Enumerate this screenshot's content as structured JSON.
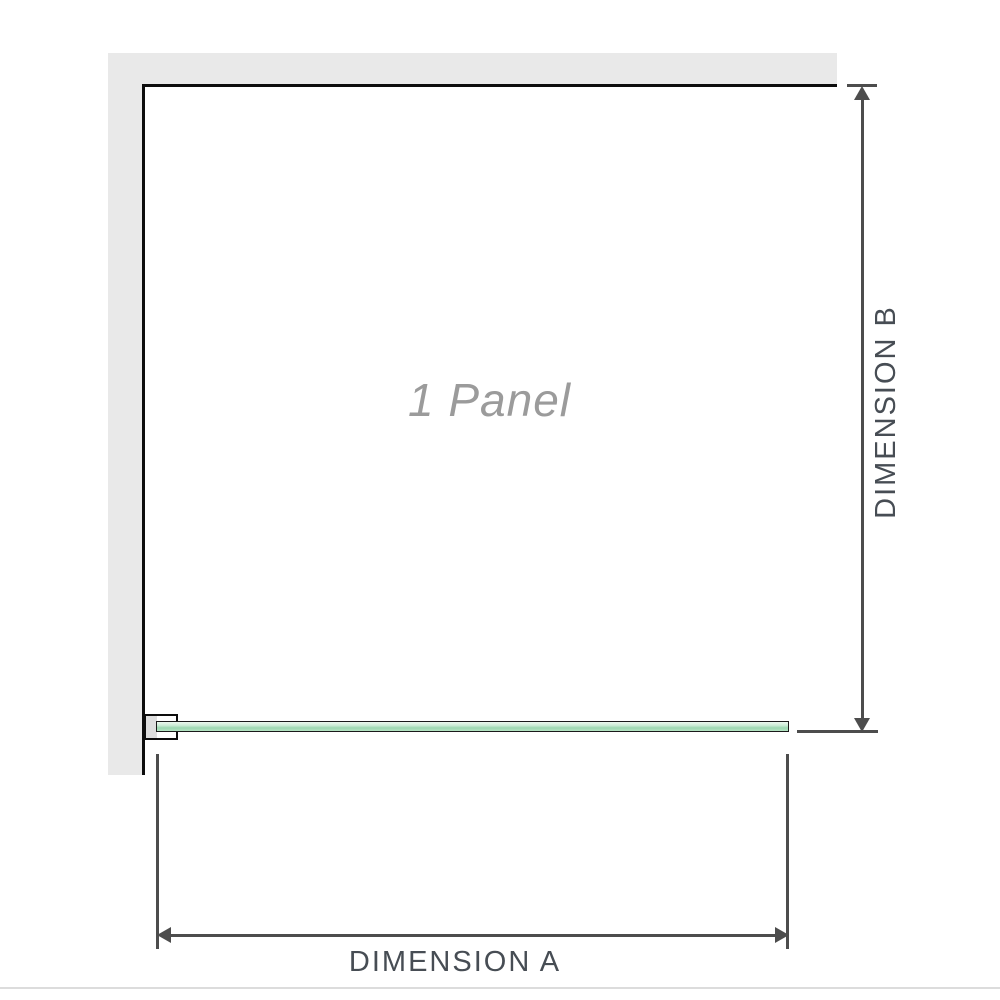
{
  "diagram": {
    "panel_label": "1 Panel",
    "dimension_a_label": "DIMENSION A",
    "dimension_b_label": "DIMENSION B"
  },
  "colors": {
    "wall_fill": "#e9e9e9",
    "wall_edge": "#0d0d0d",
    "glass_border": "#1a1a1a",
    "glass_light": "#edf8f0",
    "glass_mid": "#c9ebd4",
    "glass_dark": "#9cd8b1",
    "glass_soft": "#b5e4c3",
    "bracket_insert": "#dedede",
    "dimension_line": "#4d4d4d",
    "dimension_text": "#474d54",
    "panel_label_text": "#9b9b9b",
    "baseline": "#dcdcdc"
  }
}
